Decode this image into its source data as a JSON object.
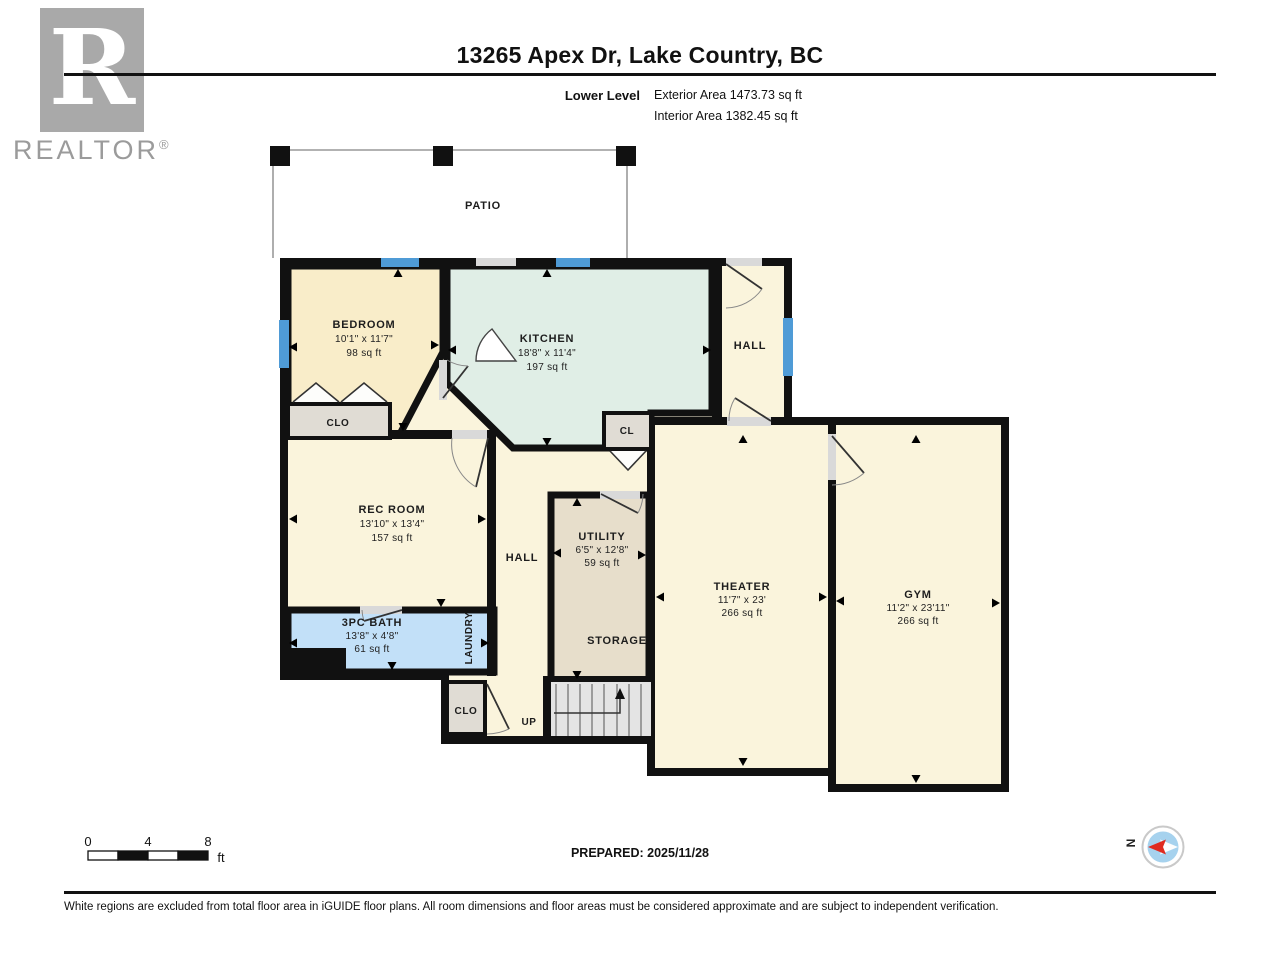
{
  "header": {
    "title": "13265 Apex Dr, Lake Country, BC",
    "level_label": "Lower Level",
    "exterior_area": "Exterior Area 1473.73 sq ft",
    "interior_area": "Interior Area 1382.45 sq ft"
  },
  "branding": {
    "logo_letter": "R",
    "logo_word": "REALTOR",
    "registered": "®"
  },
  "plan": {
    "patio": {
      "name": "PATIO"
    },
    "bedroom": {
      "name": "BEDROOM",
      "dims": "10'1\" x 11'7\"",
      "area": "98 sq ft"
    },
    "kitchen": {
      "name": "KITCHEN",
      "dims": "18'8\" x 11'4\"",
      "area": "197 sq ft"
    },
    "hall_upper": {
      "name": "HALL"
    },
    "hall_middle": {
      "name": "HALL"
    },
    "clo_bedroom": {
      "name": "CLO"
    },
    "cl_kitchen": {
      "name": "CL"
    },
    "rec_room": {
      "name": "REC ROOM",
      "dims": "13'10\" x 13'4\"",
      "area": "157 sq ft"
    },
    "bath": {
      "name": "3PC BATH",
      "dims": "13'8\" x 4'8\"",
      "area": "61 sq ft"
    },
    "laundry": {
      "name": "LAUNDRY"
    },
    "utility": {
      "name": "UTILITY",
      "dims": "6'5\" x 12'8\"",
      "area": "59 sq ft"
    },
    "storage": {
      "name": "STORAGE"
    },
    "theater": {
      "name": "THEATER",
      "dims": "11'7\" x 23'",
      "area": "266 sq ft"
    },
    "gym": {
      "name": "GYM",
      "dims": "11'2\" x 23'11\"",
      "area": "266 sq ft"
    },
    "clo_stairs": {
      "name": "CLO"
    },
    "up_label": "UP"
  },
  "scale_bar": {
    "tick_0": "0",
    "tick_4": "4",
    "tick_8": "8",
    "unit": "ft"
  },
  "prepared": "PREPARED: 2025/11/28",
  "compass": {
    "north": "N"
  },
  "disclaimer": "White regions are excluded from total floor area in iGUIDE floor plans. All room dimensions and floor areas must be considered approximate and are subject to independent verification.",
  "colors": {
    "wall": "#111111",
    "window": "#4f9bd6",
    "room_cream": "#faf4dc",
    "bedroom_fill": "#f9edc9",
    "kitchen_fill": "#e0eee6",
    "bath_fill": "#c2e0f8",
    "utility_fill": "#e7decb",
    "closet_fill": "#e0dcd4",
    "stairs_fill": "#e4e4e4",
    "compass_blue": "#a6d2ee",
    "compass_red": "#e02b20",
    "logo_gray": "#a9a9a9"
  }
}
